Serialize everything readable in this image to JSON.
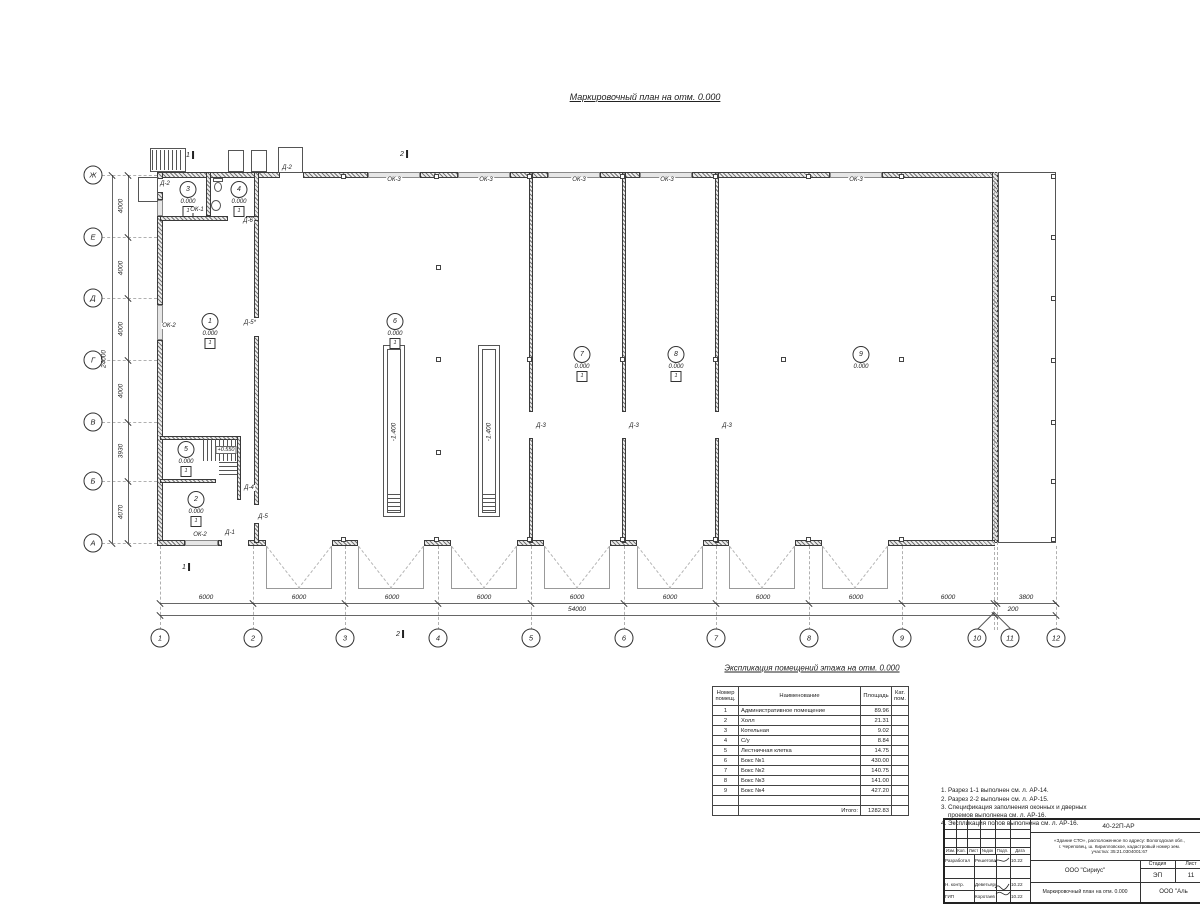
{
  "title": "Маркировочный план на отм. 0.000",
  "plan": {
    "axis_cols": [
      {
        "label": "1",
        "x": 160,
        "bx": 160
      },
      {
        "label": "2",
        "x": 253,
        "bx": 253
      },
      {
        "label": "3",
        "x": 345,
        "bx": 345
      },
      {
        "label": "4",
        "x": 438,
        "bx": 438
      },
      {
        "label": "5",
        "x": 531,
        "bx": 531
      },
      {
        "label": "6",
        "x": 624,
        "bx": 624
      },
      {
        "label": "7",
        "x": 716,
        "bx": 716
      },
      {
        "label": "8",
        "x": 809,
        "bx": 809
      },
      {
        "label": "9",
        "x": 902,
        "bx": 902
      },
      {
        "label": "10",
        "x": 994,
        "bx": 977
      },
      {
        "label": "11",
        "x": 997,
        "bx": 1010
      },
      {
        "label": "12",
        "x": 1056,
        "bx": 1056
      }
    ],
    "axis_rows": [
      {
        "label": "Ж",
        "y": 175
      },
      {
        "label": "Е",
        "y": 237
      },
      {
        "label": "Д",
        "y": 298
      },
      {
        "label": "Г",
        "y": 360
      },
      {
        "label": "В",
        "y": 422
      },
      {
        "label": "Б",
        "y": 481
      },
      {
        "label": "А",
        "y": 543
      }
    ],
    "dims_bottom": [
      {
        "t": "6000",
        "x": 206
      },
      {
        "t": "6000",
        "x": 299
      },
      {
        "t": "6000",
        "x": 392
      },
      {
        "t": "6000",
        "x": 484
      },
      {
        "t": "6000",
        "x": 577
      },
      {
        "t": "6000",
        "x": 670
      },
      {
        "t": "6000",
        "x": 763
      },
      {
        "t": "6000",
        "x": 856
      },
      {
        "t": "6000",
        "x": 948
      },
      {
        "t": "3800",
        "x": 1026
      }
    ],
    "dims_bottom2": [
      {
        "t": "54000",
        "x": 577
      },
      {
        "t": "200",
        "x": 1013
      }
    ],
    "dims_left": [
      {
        "t": "4000",
        "y": 206
      },
      {
        "t": "4000",
        "y": 268
      },
      {
        "t": "4000",
        "y": 329
      },
      {
        "t": "4000",
        "y": 391
      },
      {
        "t": "3930",
        "y": 451
      },
      {
        "t": "4070",
        "y": 512
      }
    ],
    "dim_left_total": "24000",
    "rooms": [
      {
        "n": "3",
        "x": 188,
        "y": 190,
        "elev": "0.000",
        "floor": "1"
      },
      {
        "n": "4",
        "x": 239,
        "y": 190,
        "elev": "0.000",
        "floor": "1"
      },
      {
        "n": "1",
        "x": 210,
        "y": 322,
        "elev": "0.000",
        "floor": "1"
      },
      {
        "n": "6",
        "x": 395,
        "y": 322,
        "elev": "0.000",
        "floor": "1"
      },
      {
        "n": "7",
        "x": 582,
        "y": 355,
        "elev": "0.000",
        "floor": "1"
      },
      {
        "n": "8",
        "x": 676,
        "y": 355,
        "elev": "0.000",
        "floor": "1"
      },
      {
        "n": "9",
        "x": 861,
        "y": 355,
        "elev": "0.000"
      },
      {
        "n": "5",
        "x": 186,
        "y": 450,
        "elev": "0.000",
        "floor": "1"
      },
      {
        "n": "2",
        "x": 196,
        "y": 500,
        "elev": "0.000",
        "floor": "1"
      }
    ],
    "pit_labels": [
      {
        "t": "-1.400",
        "x": 394,
        "y": 432
      },
      {
        "t": "-1.400",
        "x": 489,
        "y": 432
      }
    ],
    "stair_label": {
      "t": "+0.550",
      "x": 226,
      "y": 450
    },
    "openings": [
      {
        "t": "Д-2",
        "x": 287,
        "y": 168
      },
      {
        "t": "Д-2",
        "x": 165,
        "y": 184
      },
      {
        "t": "ОК-1",
        "x": 197,
        "y": 210
      },
      {
        "t": "Д-6",
        "x": 248,
        "y": 221
      },
      {
        "t": "ОК-2",
        "x": 169,
        "y": 326
      },
      {
        "t": "Д-5*",
        "x": 250,
        "y": 323
      },
      {
        "t": "Д-4",
        "x": 249,
        "y": 488
      },
      {
        "t": "Д-5",
        "x": 263,
        "y": 517
      },
      {
        "t": "ОК-2",
        "x": 200,
        "y": 535
      },
      {
        "t": "Д-1",
        "x": 230,
        "y": 533
      },
      {
        "t": "Д-3",
        "x": 541,
        "y": 426
      },
      {
        "t": "Д-3",
        "x": 634,
        "y": 426
      },
      {
        "t": "Д-3",
        "x": 727,
        "y": 426
      },
      {
        "t": "ОК-3",
        "x": 394,
        "y": 180
      },
      {
        "t": "ОК-3",
        "x": 486,
        "y": 180
      },
      {
        "t": "ОК-3",
        "x": 579,
        "y": 180
      },
      {
        "t": "ОК-3",
        "x": 667,
        "y": 180
      },
      {
        "t": "ОК-3",
        "x": 856,
        "y": 180
      }
    ],
    "sections": [
      {
        "t": "1",
        "x": 190,
        "y": 155
      },
      {
        "t": "2",
        "x": 404,
        "y": 154
      },
      {
        "t": "2",
        "x": 400,
        "y": 634
      },
      {
        "t": "1",
        "x": 186,
        "y": 567
      }
    ],
    "walls": [
      {
        "x": 160,
        "y": 172,
        "w": 120,
        "h": 6
      },
      {
        "x": 303,
        "y": 172,
        "w": 65,
        "h": 6
      },
      {
        "x": 420,
        "y": 172,
        "w": 38,
        "h": 6
      },
      {
        "x": 510,
        "y": 172,
        "w": 38,
        "h": 6
      },
      {
        "x": 600,
        "y": 172,
        "w": 40,
        "h": 6
      },
      {
        "x": 692,
        "y": 172,
        "w": 138,
        "h": 6
      },
      {
        "x": 882,
        "y": 172,
        "w": 113,
        "h": 6
      },
      {
        "x": 157,
        "y": 172,
        "w": 6,
        "h": 7
      },
      {
        "x": 157,
        "y": 192,
        "w": 6,
        "h": 8
      },
      {
        "x": 157,
        "y": 216,
        "w": 6,
        "h": 89
      },
      {
        "x": 157,
        "y": 340,
        "w": 6,
        "h": 203
      },
      {
        "x": 992,
        "y": 172,
        "w": 6,
        "h": 371
      },
      {
        "x": 157,
        "y": 540,
        "w": 28,
        "h": 6
      },
      {
        "x": 218,
        "y": 540,
        "w": 4,
        "h": 6
      },
      {
        "x": 248,
        "y": 540,
        "w": 18,
        "h": 6
      },
      {
        "x": 332,
        "y": 540,
        "w": 26,
        "h": 6
      },
      {
        "x": 424,
        "y": 540,
        "w": 27,
        "h": 6
      },
      {
        "x": 517,
        "y": 540,
        "w": 27,
        "h": 6
      },
      {
        "x": 610,
        "y": 540,
        "w": 27,
        "h": 6
      },
      {
        "x": 703,
        "y": 540,
        "w": 26,
        "h": 6
      },
      {
        "x": 795,
        "y": 540,
        "w": 27,
        "h": 6
      },
      {
        "x": 888,
        "y": 540,
        "w": 107,
        "h": 6
      },
      {
        "x": 254,
        "y": 172,
        "w": 5,
        "h": 146
      },
      {
        "x": 254,
        "y": 336,
        "w": 5,
        "h": 169
      },
      {
        "x": 254,
        "y": 523,
        "w": 5,
        "h": 20
      },
      {
        "x": 160,
        "y": 216,
        "w": 68,
        "h": 5
      },
      {
        "x": 246,
        "y": 216,
        "w": 13,
        "h": 5
      },
      {
        "x": 206,
        "y": 172,
        "w": 5,
        "h": 44
      },
      {
        "x": 529,
        "y": 172,
        "w": 4,
        "h": 240
      },
      {
        "x": 529,
        "y": 438,
        "w": 4,
        "h": 105
      },
      {
        "x": 622,
        "y": 172,
        "w": 4,
        "h": 240
      },
      {
        "x": 622,
        "y": 438,
        "w": 4,
        "h": 105
      },
      {
        "x": 715,
        "y": 172,
        "w": 4,
        "h": 240
      },
      {
        "x": 715,
        "y": 438,
        "w": 4,
        "h": 105
      },
      {
        "x": 160,
        "y": 436,
        "w": 81,
        "h": 4
      },
      {
        "x": 237,
        "y": 436,
        "w": 4,
        "h": 64
      },
      {
        "x": 160,
        "y": 479,
        "w": 56,
        "h": 4
      }
    ],
    "wins": [
      {
        "x": 368,
        "y": 172,
        "w": 52,
        "h": 6
      },
      {
        "x": 458,
        "y": 172,
        "w": 52,
        "h": 6
      },
      {
        "x": 548,
        "y": 172,
        "w": 52,
        "h": 6
      },
      {
        "x": 640,
        "y": 172,
        "w": 52,
        "h": 6
      },
      {
        "x": 830,
        "y": 172,
        "w": 52,
        "h": 6
      },
      {
        "x": 157,
        "y": 200,
        "w": 6,
        "h": 16
      },
      {
        "x": 157,
        "y": 305,
        "w": 6,
        "h": 35
      },
      {
        "x": 185,
        "y": 540,
        "w": 33,
        "h": 6
      }
    ],
    "rects": [
      {
        "x": 383,
        "y": 345,
        "w": 22,
        "h": 172
      },
      {
        "x": 387,
        "y": 349,
        "w": 14,
        "h": 164
      },
      {
        "x": 478,
        "y": 345,
        "w": 22,
        "h": 172
      },
      {
        "x": 482,
        "y": 349,
        "w": 14,
        "h": 164
      },
      {
        "x": 998,
        "y": 172,
        "w": 58,
        "h": 371
      },
      {
        "x": 278,
        "y": 147,
        "w": 25,
        "h": 26
      },
      {
        "x": 228,
        "y": 150,
        "w": 16,
        "h": 22
      },
      {
        "x": 251,
        "y": 150,
        "w": 16,
        "h": 22
      },
      {
        "x": 150,
        "y": 148,
        "w": 36,
        "h": 24
      },
      {
        "x": 138,
        "y": 177,
        "w": 20,
        "h": 25
      }
    ],
    "tredv": [
      {
        "x": 152,
        "y": 150,
        "w": 32,
        "h": 20
      },
      {
        "x": 203,
        "y": 439,
        "w": 34,
        "h": 22
      }
    ],
    "tredh": [
      {
        "x": 387,
        "y": 494,
        "w": 14,
        "h": 19
      },
      {
        "x": 482,
        "y": 494,
        "w": 14,
        "h": 19
      },
      {
        "x": 219,
        "y": 462,
        "w": 18,
        "h": 15
      }
    ],
    "squares": [
      {
        "x": 341,
        "y": 174
      },
      {
        "x": 434,
        "y": 174
      },
      {
        "x": 527,
        "y": 174
      },
      {
        "x": 620,
        "y": 174
      },
      {
        "x": 713,
        "y": 174
      },
      {
        "x": 806,
        "y": 174
      },
      {
        "x": 899,
        "y": 174
      },
      {
        "x": 436,
        "y": 265
      },
      {
        "x": 436,
        "y": 357
      },
      {
        "x": 436,
        "y": 450
      },
      {
        "x": 527,
        "y": 357
      },
      {
        "x": 620,
        "y": 357
      },
      {
        "x": 713,
        "y": 357
      },
      {
        "x": 781,
        "y": 357
      },
      {
        "x": 899,
        "y": 357
      },
      {
        "x": 341,
        "y": 537
      },
      {
        "x": 434,
        "y": 537
      },
      {
        "x": 527,
        "y": 537
      },
      {
        "x": 620,
        "y": 537
      },
      {
        "x": 713,
        "y": 537
      },
      {
        "x": 806,
        "y": 537
      },
      {
        "x": 899,
        "y": 537
      },
      {
        "x": 1051,
        "y": 174
      },
      {
        "x": 1051,
        "y": 235
      },
      {
        "x": 1051,
        "y": 296
      },
      {
        "x": 1051,
        "y": 358
      },
      {
        "x": 1051,
        "y": 420
      },
      {
        "x": 1051,
        "y": 479
      },
      {
        "x": 1051,
        "y": 537
      }
    ],
    "aprons": [
      {
        "x": 266,
        "y": 546
      },
      {
        "x": 358,
        "y": 546
      },
      {
        "x": 451,
        "y": 546
      },
      {
        "x": 544,
        "y": 546
      },
      {
        "x": 637,
        "y": 546
      },
      {
        "x": 729,
        "y": 546
      },
      {
        "x": 822,
        "y": 546
      }
    ],
    "dashv": [
      {
        "x": 160,
        "y": 546,
        "h": 84
      },
      {
        "x": 253,
        "y": 546,
        "h": 84
      },
      {
        "x": 345,
        "y": 546,
        "h": 84
      },
      {
        "x": 438,
        "y": 546,
        "h": 84
      },
      {
        "x": 531,
        "y": 546,
        "h": 84
      },
      {
        "x": 624,
        "y": 546,
        "h": 84
      },
      {
        "x": 716,
        "y": 546,
        "h": 84
      },
      {
        "x": 809,
        "y": 546,
        "h": 84
      },
      {
        "x": 902,
        "y": 546,
        "h": 84
      },
      {
        "x": 994,
        "y": 172,
        "h": 458
      },
      {
        "x": 997,
        "y": 172,
        "h": 458
      },
      {
        "x": 1056,
        "y": 546,
        "h": 84
      }
    ],
    "dashh": [
      {
        "x": 102,
        "y": 175,
        "w": 55
      },
      {
        "x": 102,
        "y": 237,
        "w": 55
      },
      {
        "x": 102,
        "y": 298,
        "w": 55
      },
      {
        "x": 102,
        "y": 360,
        "w": 55
      },
      {
        "x": 102,
        "y": 422,
        "w": 55
      },
      {
        "x": 102,
        "y": 481,
        "w": 55
      },
      {
        "x": 102,
        "y": 543,
        "w": 55
      }
    ],
    "ticks_extra": [
      {
        "x": 1056,
        "y": 603
      },
      {
        "x": 160,
        "y": 615
      },
      {
        "x": 995,
        "y": 615
      },
      {
        "x": 1056,
        "y": 615
      },
      {
        "x": 112,
        "y": 175
      },
      {
        "x": 112,
        "y": 543
      }
    ]
  },
  "table": {
    "title": "Экспликация помещений этажа на отм. 0.000",
    "headers": [
      "Номер помещ.",
      "Наименование",
      "Площадь",
      "Кат. пом."
    ],
    "rows": [
      {
        "n": "1",
        "name": "Административное помещение",
        "area": "89.96"
      },
      {
        "n": "2",
        "name": "Холл",
        "area": "21.31"
      },
      {
        "n": "3",
        "name": "Котельная",
        "area": "9.02"
      },
      {
        "n": "4",
        "name": "С/у",
        "area": "8.84"
      },
      {
        "n": "5",
        "name": "Лестничная клетка",
        "area": "14.75"
      },
      {
        "n": "6",
        "name": "Бокс №1",
        "area": "430.00"
      },
      {
        "n": "7",
        "name": "Бокс №2",
        "area": "140.75"
      },
      {
        "n": "8",
        "name": "Бокс №3",
        "area": "141.00"
      },
      {
        "n": "9",
        "name": "Бокс №4",
        "area": "427.20"
      }
    ],
    "total_label": "Итого:",
    "total_value": "1282.83"
  },
  "notes": {
    "lines": [
      {
        "t": "1. Разрез 1-1 выполнен см. л. АР-14."
      },
      {
        "t": "2. Разрез 2-2 выполнен см. л. АР-15."
      },
      {
        "t": "3. Спецификация заполнения оконных и дверных"
      },
      {
        "t": "    проемов выполнена см. л. АР-16."
      },
      {
        "t": "4. Экспликация полов выполнена см. л. АР-16."
      }
    ]
  },
  "titleblock": {
    "doc_number": "40-22П-АР",
    "project_line1": "«Здание СТО», расположенное по адресу: Вологодская обл.,",
    "project_line2": "г. Череповец, ш. Кирилловское, кадастровый номер зем.",
    "project_line3": "участка: 35:21.0304001:67",
    "cols": [
      "Изм.",
      "Кол.",
      "Лист",
      "№док",
      "Подп.",
      "Дата"
    ],
    "rows": [
      {
        "y": 34,
        "role": "Разработал",
        "name": "Решетова",
        "date": "10.22"
      },
      {
        "y": 46,
        "role": "",
        "name": "",
        "date": ""
      },
      {
        "y": 58,
        "role": "Н. контр.",
        "name": "Деветьярова",
        "date": "10.22"
      },
      {
        "y": 70,
        "role": "ГИП",
        "name": "Коротаев",
        "date": "10.22"
      }
    ],
    "org": "ООО \"Сириус\"",
    "stage_label": "Стадия",
    "sheet_label": "Лист",
    "stage": "ЭП",
    "sheet": "11",
    "drawing_title": "Маркировочный план на отм. 0.000",
    "org2": "ООО \"Аль"
  }
}
